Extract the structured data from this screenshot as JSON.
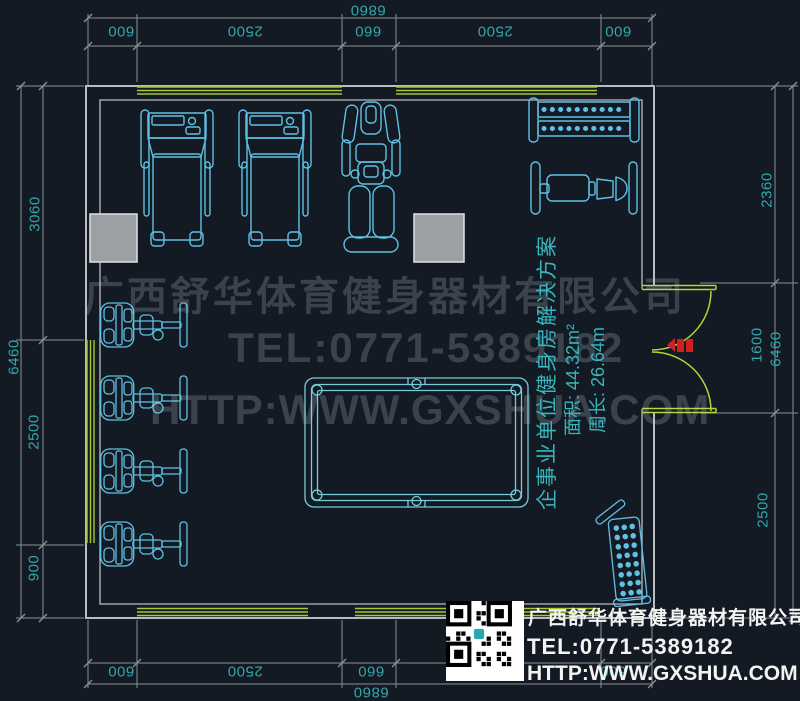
{
  "dims": {
    "top": {
      "overall": "6860",
      "segments": [
        "600",
        "2500",
        "660",
        "2500",
        "600"
      ]
    },
    "bottom": {
      "overall": "6860",
      "segments": [
        "600",
        "2500",
        "660",
        "2500",
        "600"
      ]
    },
    "left": {
      "overall": "6460",
      "segments": [
        "3060",
        "2500",
        "900"
      ]
    },
    "right": {
      "overall": "6460",
      "segments": [
        "2360",
        "1600",
        "2500"
      ]
    }
  },
  "info": {
    "title": "企事业单位健身房解决方案",
    "area": "面积: 44.32m²",
    "perimeter": "周长: 26.64m"
  },
  "watermark": {
    "company": "广西舒华体育健身器材有限公司",
    "tel": "TEL:0771-5389182",
    "url": "HTTP:WWW.GXSHUA.COM"
  },
  "contact": {
    "company": "广西舒华体育健身器材有限公司",
    "tel": "TEL:0771-5389182",
    "url": "HTTP:WWW.GXSHUA.COM"
  },
  "colors": {
    "background": "#131a23",
    "equipment_line": "#5ec1e4",
    "pool_table_line": "#76ccd8",
    "dimension_text": "#2fa8ac",
    "dimension_line": "#8a9096",
    "wall_line": "#b9bdc2",
    "window_line": "#a6c832",
    "door_line": "#b5d636",
    "entrance_marker": "#d21f1f",
    "column_fill": "#9c9fa3",
    "contact_text": "#f3f3f3"
  }
}
